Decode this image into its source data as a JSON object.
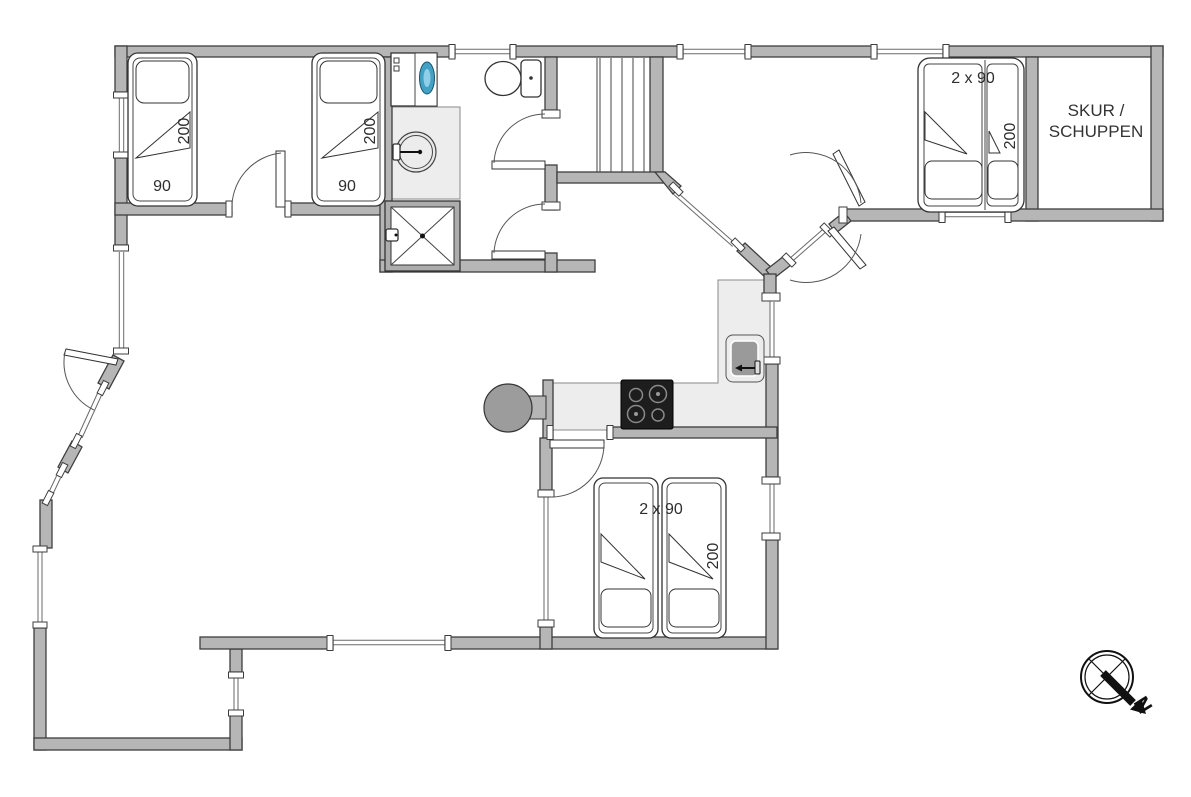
{
  "floorplan": {
    "colors": {
      "wall": "#b6b6b6",
      "wall_outline": "#3e3e3e",
      "counter": "#ededed",
      "cooktop": "#1d1d1d",
      "stove": "#9c9c9c",
      "sink_basin": "#9a9a9a",
      "washer_door": "#44a1c6"
    },
    "labels": {
      "bed1_length": "200",
      "bed1_width": "90",
      "bed2_length": "200",
      "bed2_width": "90",
      "bed3_size": "2 x 90",
      "bed3_length": "200",
      "bed4_size": "2 x 90",
      "bed4_length": "200",
      "shed_name_line1": "SKUR /",
      "shed_name_line2": "SCHUPPEN",
      "compass_north": "N"
    },
    "icons": {
      "toilet": "toilet-icon",
      "washbasin": "washbasin-icon",
      "shower": "shower-icon",
      "washing_machine": "washing-machine-icon",
      "stairs": "stairs-icon",
      "cooktop": "cooktop-icon",
      "kitchen_sink": "kitchen-sink-icon",
      "wood_stove": "wood-stove-icon",
      "compass": "compass-north-icon"
    }
  }
}
